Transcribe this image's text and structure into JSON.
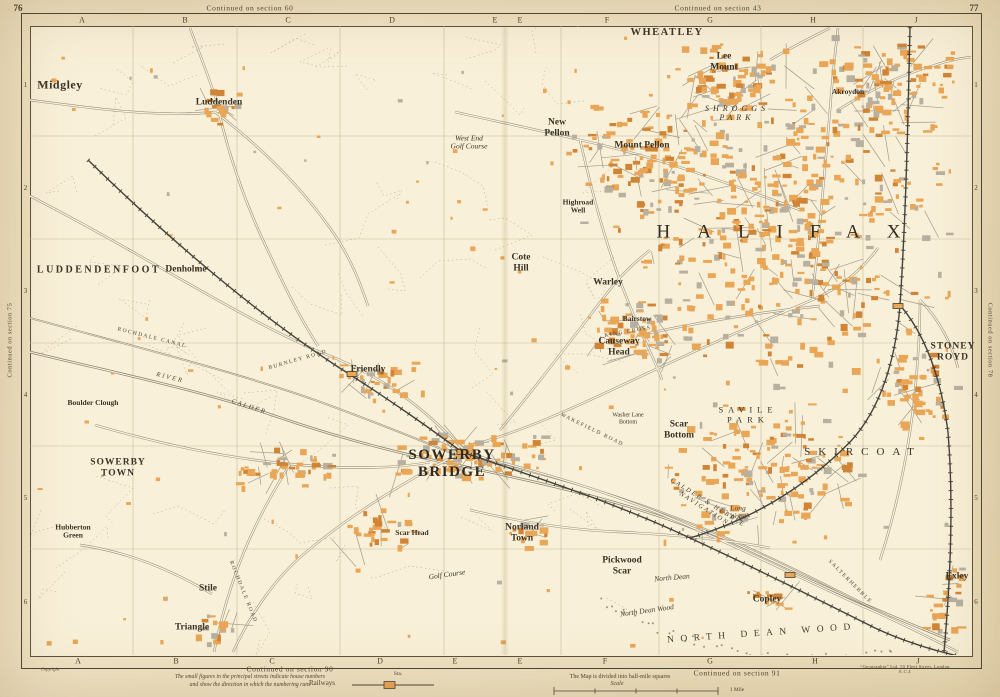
{
  "page": {
    "left_no": "76",
    "right_no": "77"
  },
  "margins": {
    "top_left": "Continued on section 60",
    "top_right": "Continued on section 43",
    "bottom_left": "Continued on section 90",
    "bottom_right": "Continued on section 91",
    "left": "Continued on section 75",
    "right": "Continued on section 78"
  },
  "grid": {
    "top_letters": [
      {
        "t": "A",
        "x": 82
      },
      {
        "t": "B",
        "x": 185
      },
      {
        "t": "C",
        "x": 288
      },
      {
        "t": "D",
        "x": 392
      },
      {
        "t": "E",
        "x": 495
      },
      {
        "t": "E",
        "x": 520
      },
      {
        "t": "F",
        "x": 607
      },
      {
        "t": "G",
        "x": 710
      },
      {
        "t": "H",
        "x": 813
      },
      {
        "t": "J",
        "x": 916
      }
    ],
    "bottom_letters": [
      {
        "t": "A",
        "x": 78
      },
      {
        "t": "B",
        "x": 176
      },
      {
        "t": "C",
        "x": 272
      },
      {
        "t": "D",
        "x": 380
      },
      {
        "t": "E",
        "x": 455
      },
      {
        "t": "E",
        "x": 520
      },
      {
        "t": "F",
        "x": 605
      },
      {
        "t": "G",
        "x": 710
      },
      {
        "t": "H",
        "x": 815
      },
      {
        "t": "J",
        "x": 918
      }
    ],
    "rows": [
      {
        "t": "1",
        "y": 85
      },
      {
        "t": "2",
        "y": 188
      },
      {
        "t": "3",
        "y": 291
      },
      {
        "t": "4",
        "y": 395
      },
      {
        "t": "5",
        "y": 498
      },
      {
        "t": "6",
        "y": 602
      }
    ]
  },
  "labels": [
    {
      "t": "Midgley",
      "c": "vill-lg",
      "x": 60,
      "y": 85
    },
    {
      "t": "Luddenden",
      "c": "vill",
      "x": 219,
      "y": 103
    },
    {
      "t": "LUDDENDENFOOT",
      "c": "dist",
      "x": 99,
      "y": 270
    },
    {
      "t": "Denholme",
      "c": "vill",
      "x": 186,
      "y": 270
    },
    {
      "t": "Warley",
      "c": "vill",
      "x": 608,
      "y": 283
    },
    {
      "t": "Bairstow",
      "c": "small",
      "x": 637,
      "y": 319
    },
    {
      "t": "Causeway\nHead",
      "c": "vill",
      "x": 619,
      "y": 347
    },
    {
      "t": "Friendly",
      "c": "vill",
      "x": 368,
      "y": 370
    },
    {
      "t": "Cote\nHill",
      "c": "vill",
      "x": 521,
      "y": 263
    },
    {
      "t": "New\nPellon",
      "c": "vill",
      "x": 557,
      "y": 128
    },
    {
      "t": "Mount Pellon",
      "c": "vill",
      "x": 642,
      "y": 146
    },
    {
      "t": "WHEATLEY",
      "c": "town2",
      "x": 667,
      "y": 33
    },
    {
      "t": "Lee\nMount",
      "c": "vill",
      "x": 724,
      "y": 62
    },
    {
      "t": "SHROGGS\nPARK",
      "c": "park",
      "x": 737,
      "y": 114
    },
    {
      "t": "HALIFAX",
      "c": "big",
      "x": 792,
      "y": 232
    },
    {
      "t": "Akroydon",
      "c": "small",
      "x": 848,
      "y": 92
    },
    {
      "t": "STONEY\nROYD",
      "c": "dist2",
      "x": 953,
      "y": 352
    },
    {
      "t": "Scar\nBottom",
      "c": "vill",
      "x": 679,
      "y": 430
    },
    {
      "t": "SAVILE\nPARK",
      "c": "park2",
      "x": 748,
      "y": 415
    },
    {
      "t": "SKIRCOAT",
      "c": "dist-wide",
      "x": 863,
      "y": 452
    },
    {
      "t": "SOWERBY\nBRIDGE",
      "c": "town",
      "x": 452,
      "y": 464
    },
    {
      "t": "SOWERBY\nTOWN",
      "c": "dist2",
      "x": 118,
      "y": 468
    },
    {
      "t": "Boulder Clough",
      "c": "small",
      "x": 93,
      "y": 403
    },
    {
      "t": "Hubberton\nGreen",
      "c": "small",
      "x": 73,
      "y": 532
    },
    {
      "t": "Stile",
      "c": "vill",
      "x": 208,
      "y": 589
    },
    {
      "t": "Triangle",
      "c": "vill",
      "x": 192,
      "y": 628
    },
    {
      "t": "Norland\nTown",
      "c": "vill",
      "x": 522,
      "y": 533
    },
    {
      "t": "Pickwood\nScar",
      "c": "vill",
      "x": 622,
      "y": 566
    },
    {
      "t": "Copley",
      "c": "vill",
      "x": 767,
      "y": 600
    },
    {
      "t": "Exley",
      "c": "vill",
      "x": 957,
      "y": 577
    },
    {
      "t": "Scar Head",
      "c": "small",
      "x": 412,
      "y": 533
    },
    {
      "t": "NORTH DEAN WOOD",
      "c": "wood",
      "x": 762,
      "y": 634,
      "r": -4
    },
    {
      "t": "North Dean Wood",
      "c": "script",
      "x": 647,
      "y": 611,
      "r": -8
    },
    {
      "t": "North Dean",
      "c": "script",
      "x": 672,
      "y": 578,
      "r": -5
    },
    {
      "t": "West End\nGolf Course",
      "c": "ital",
      "x": 469,
      "y": 143
    },
    {
      "t": "Golf Course",
      "c": "ital",
      "x": 447,
      "y": 575,
      "r": -8
    },
    {
      "t": "Highroad\nWell",
      "c": "small",
      "x": 578,
      "y": 207
    },
    {
      "t": "Long\nWood",
      "c": "script",
      "x": 738,
      "y": 513
    },
    {
      "t": "Washer Lane\nBottom",
      "c": "tiny",
      "x": 628,
      "y": 419
    },
    {
      "t": "ROCHDALE CANAL",
      "c": "road",
      "x": 152,
      "y": 338,
      "r": 14
    },
    {
      "t": "RIVER",
      "c": "riv",
      "x": 170,
      "y": 378,
      "r": 14
    },
    {
      "t": "CALDER",
      "c": "riv",
      "x": 249,
      "y": 407,
      "r": 18
    },
    {
      "t": "BURNLEY ROAD",
      "c": "road",
      "x": 298,
      "y": 360,
      "r": -16
    },
    {
      "t": "WAKEFIELD ROAD",
      "c": "road",
      "x": 592,
      "y": 430,
      "r": 26
    },
    {
      "t": "ROCHDALE ROAD",
      "c": "road",
      "x": 243,
      "y": 592,
      "r": 68
    },
    {
      "t": "CALDER & HEBBLE\nNAVIGATION",
      "c": "riv",
      "x": 706,
      "y": 506,
      "r": 32
    },
    {
      "t": "KING CROSS",
      "c": "road",
      "x": 628,
      "y": 332,
      "r": -10
    },
    {
      "t": "SALTERHEBBLE",
      "c": "road",
      "x": 850,
      "y": 582,
      "r": 45
    }
  ],
  "legend": {
    "copyright": "Copyright",
    "note": "The small figures in the principal streets indicate house numbers\nand show the direction in which the numbering runs",
    "railways": "Railways",
    "station": "Sta.",
    "divided": "The Map is divided into half-mile squares",
    "scale": "Scale",
    "mile": "1 Mile",
    "imprint": "“Geographia” Ltd. 55 Fleet Street, London E.C.4"
  },
  "colors": {
    "paper": "#efe2c2",
    "map_bg": "#f8f0d8",
    "building": "#e9a656",
    "building_dark": "#d08436",
    "building_gray": "#b7b0a0",
    "road_casing": "#968f7c",
    "road_fill": "#faf3de",
    "rail": "#45423a",
    "water": "#8d8674",
    "grid": "#cbbc9b",
    "rural": "#b5a98c",
    "ink": "#3c352a"
  }
}
